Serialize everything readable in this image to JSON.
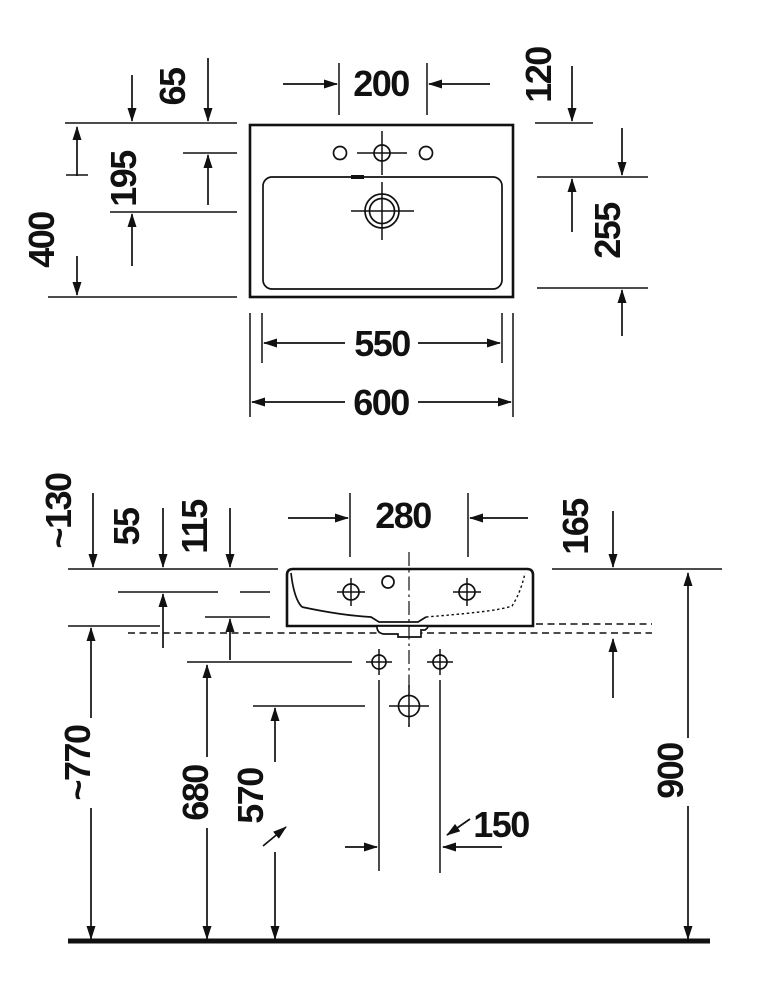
{
  "drawing": {
    "kind": "washbasin technical drawing",
    "colors": {
      "ink": "#111111",
      "background": "#ffffff"
    }
  },
  "dims": {
    "plan": {
      "d65": "65",
      "d195": "195",
      "d400": "400",
      "d200": "200",
      "d120": "120",
      "d255": "255",
      "d550": "550",
      "d600": "600"
    },
    "front": {
      "d130": "~130",
      "d55": "55",
      "d115": "115",
      "d280": "280",
      "d165": "165",
      "d770": "~770",
      "d680": "680",
      "d570": "570",
      "d150": "150",
      "d900": "900"
    }
  }
}
